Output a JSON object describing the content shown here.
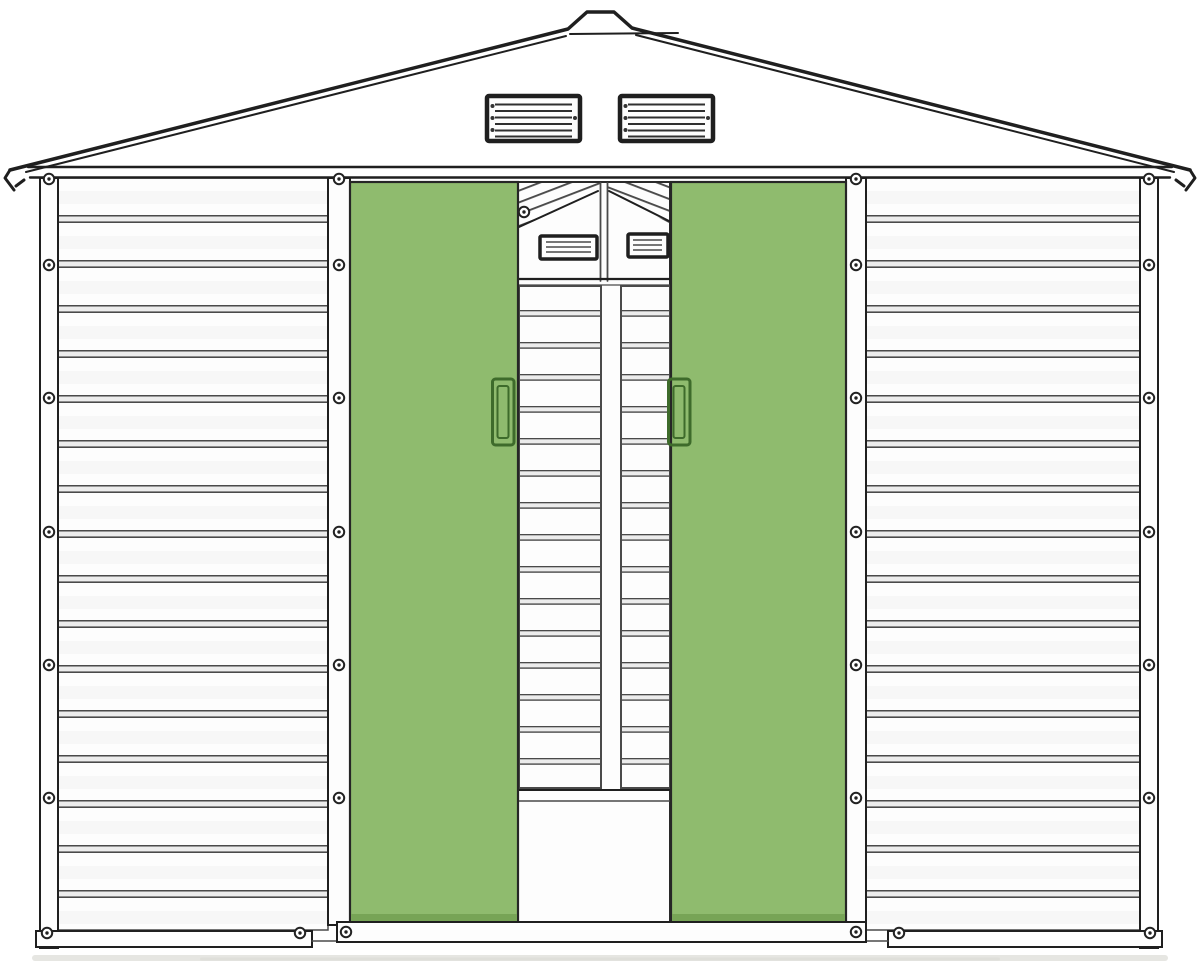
{
  "meta": {
    "description": "Line-art product illustration of a metal garden shed, front elevation, with two green sliding doors",
    "canvas": {
      "width": 1200,
      "height": 972
    }
  },
  "colors": {
    "background": "#ffffff",
    "line_dark": "#1f1f1f",
    "line_mid": "#4a4a4a",
    "panel_white": "#fdfdfd",
    "panel_groove": "#ececec",
    "door_green": "#8fbb6e",
    "door_green_edge": "#77a456",
    "handle_green": "#3e6b2b",
    "ground_shadow": "#e6e6e2"
  },
  "shed": {
    "roof": {
      "type": "gable-with-ridge-cap",
      "gable_vents": {
        "count": 2,
        "louvers_per_vent": 6,
        "frame_pins_per_vent": 4
      }
    },
    "walls": {
      "left": {
        "corrugation_grooves": 16,
        "frame_screws": 14
      },
      "right": {
        "corrugation_grooves": 16,
        "frame_screws": 14
      }
    },
    "door_opening": {
      "outer_sliding_doors": {
        "count": 2,
        "handles": 2
      },
      "inner_doors": {
        "count": 2,
        "vents": 2,
        "louvers_per_vent": 3,
        "ribbed": true,
        "top_screws": 1
      },
      "bottom_track_screws": 2
    },
    "base": {
      "ground_shadow": true
    }
  }
}
